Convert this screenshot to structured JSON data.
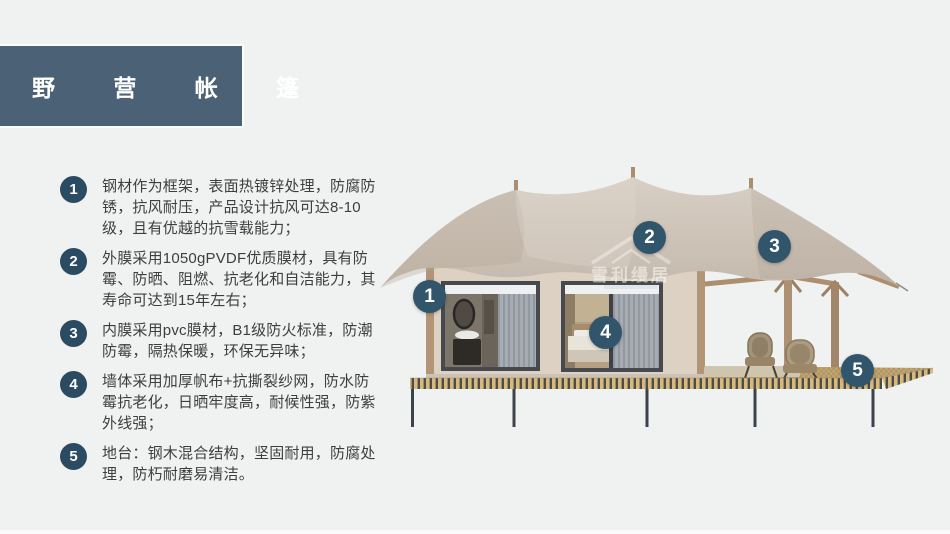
{
  "slide": {
    "title": "野 营 帐 篷"
  },
  "features": [
    {
      "num": "1",
      "text": "钢材作为框架，表面热镀锌处理，防腐防锈，抗风耐压，产品设计抗风可达8-10级，且有优越的抗雪载能力；"
    },
    {
      "num": "2",
      "text": "外膜采用1050gPVDF优质膜材，具有防霉、防晒、阻燃、抗老化和自洁能力，其寿命可达到15年左右；"
    },
    {
      "num": "3",
      "text": "内膜采用pvc膜材，B1级防火标准，防潮防霉，隔热保暖，环保无异味；"
    },
    {
      "num": "4",
      "text": "墙体采用加厚帆布+抗撕裂纱网，防水防霉抗老化，日晒牢度高，耐候性强，防紫外线强；"
    },
    {
      "num": "5",
      "text": "地台：钢木混合结构，坚固耐用，防腐处理，防朽耐磨易清洁。"
    }
  ],
  "markers": [
    {
      "label": "1"
    },
    {
      "label": "2"
    },
    {
      "label": "3"
    },
    {
      "label": "4"
    },
    {
      "label": "5"
    }
  ],
  "watermark": {
    "text": "雪利缦居"
  },
  "colors": {
    "background": "#f0f1f1",
    "title_bg": "#4b6276",
    "badge": "#2b4b62",
    "image_marker": "#31566c",
    "canopy": "#cdc3b8",
    "wall": "#dcd1c3",
    "wood": "#ad9172",
    "deck_slat": "#d7b97e"
  }
}
